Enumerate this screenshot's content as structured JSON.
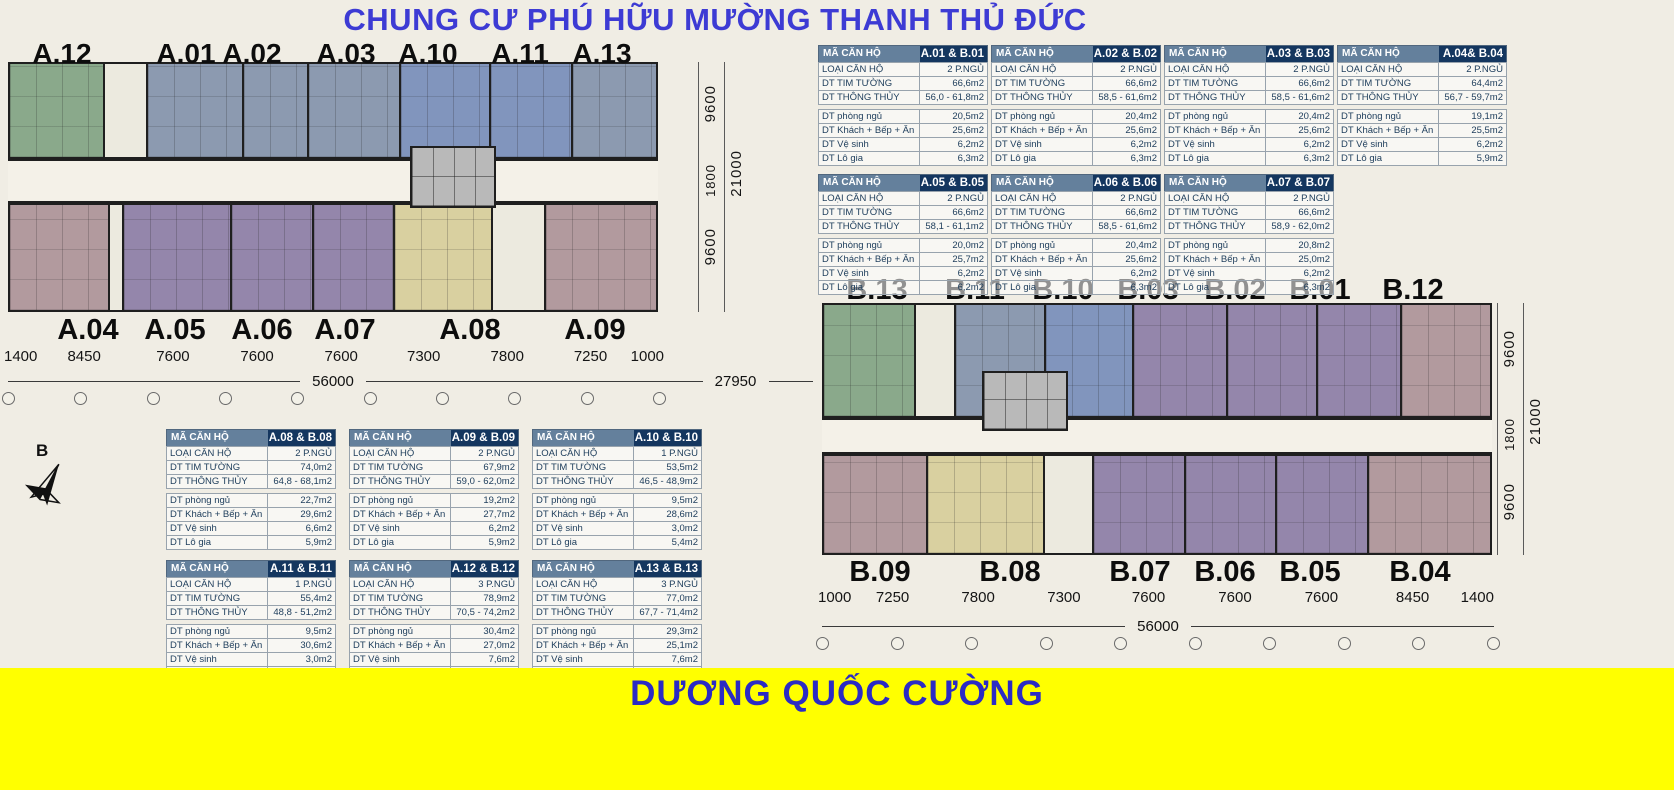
{
  "title": "CHUNG CƯ PHÚ HỮU MƯỜNG THANH THỦ ĐỨC",
  "footer": "DƯƠNG QUỐC CƯỜNG",
  "compass": {
    "north_label": "B"
  },
  "colors": {
    "title_blue": "#3d3bd4",
    "footer_yellow": "#ffff00",
    "footer_text_blue": "#2b2bc4",
    "table_header_steel": "#64809c",
    "table_header_navy": "#14365f",
    "unit_green": "#8aa98b",
    "unit_slate": "#8c9ab0",
    "unit_blue": "#8195bd",
    "unit_purple": "#9486ab",
    "unit_mauve": "#b29a9e",
    "unit_tan": "#d9d0a0"
  },
  "block_a": {
    "top_labels": [
      "A.12",
      "A.01",
      "A.02",
      "A.03",
      "A.10",
      "A.11",
      "A.13"
    ],
    "bottom_labels": [
      "A.04",
      "A.05",
      "A.06",
      "A.07",
      "A.08",
      "A.09"
    ],
    "dims_bottom": [
      "1400",
      "8450",
      "7600",
      "7600",
      "7600",
      "7300",
      "7800",
      "7250",
      "1000"
    ],
    "dim_total": "56000",
    "dim_gap": "27950",
    "dims_side": [
      "9600",
      "1800",
      "9600"
    ],
    "dim_side_total": "21000"
  },
  "block_b": {
    "top_labels": [
      "B.13",
      "B.11",
      "B.10",
      "B.03",
      "B.02",
      "B.01",
      "B.12"
    ],
    "bottom_labels": [
      "B.09",
      "B.08",
      "B.07",
      "B.06",
      "B.05",
      "B.04"
    ],
    "dims_bottom": [
      "1000",
      "7250",
      "7800",
      "7300",
      "7600",
      "7600",
      "7600",
      "8450",
      "1400"
    ],
    "dim_total": "56000",
    "dims_side": [
      "9600",
      "1800",
      "9600"
    ],
    "dim_side_total": "21000"
  },
  "table_labels": {
    "code": "MÃ CĂN HỘ",
    "type": "LOẠI CĂN HỘ",
    "tim": "DT TIM TƯỜNG",
    "thong": "DT THÔNG THỦY",
    "ngu": "DT phòng ngủ",
    "khach": "DT Khách + Bếp + Ăn",
    "ve": "DT Vệ sinh",
    "lo": "DT Lô gia"
  },
  "tables": [
    {
      "code": "A.01 & B.01",
      "type": "2 P.NGỦ",
      "tim": "66,6m2",
      "thong": "56,0 - 61,8m2",
      "ngu": "20,5m2",
      "khach": "25,6m2",
      "ve": "6,2m2",
      "lo": "6,3m2"
    },
    {
      "code": "A.02 & B.02",
      "type": "2 P.NGỦ",
      "tim": "66,6m2",
      "thong": "58,5 - 61,6m2",
      "ngu": "20,4m2",
      "khach": "25,6m2",
      "ve": "6,2m2",
      "lo": "6,3m2"
    },
    {
      "code": "A.03 & B.03",
      "type": "2 P.NGỦ",
      "tim": "66,6m2",
      "thong": "58,5 - 61,6m2",
      "ngu": "20,4m2",
      "khach": "25,6m2",
      "ve": "6,2m2",
      "lo": "6,3m2"
    },
    {
      "code": "A.04& B.04",
      "type": "2 P.NGỦ",
      "tim": "64,4m2",
      "thong": "56,7 - 59,7m2",
      "ngu": "19,1m2",
      "khach": "25,5m2",
      "ve": "6,2m2",
      "lo": "5,9m2"
    },
    {
      "code": "A.05 & B.05",
      "type": "2 P.NGỦ",
      "tim": "66,6m2",
      "thong": "58,1 - 61,1m2",
      "ngu": "20,0m2",
      "khach": "25,7m2",
      "ve": "6,2m2",
      "lo": "6,2m2"
    },
    {
      "code": "A.06 & B.06",
      "type": "2 P.NGỦ",
      "tim": "66,6m2",
      "thong": "58,5 - 61,6m2",
      "ngu": "20,4m2",
      "khach": "25,6m2",
      "ve": "6,2m2",
      "lo": "6,3m2"
    },
    {
      "code": "A.07 & B.07",
      "type": "2 P.NGỦ",
      "tim": "66,6m2",
      "thong": "58,9 - 62,0m2",
      "ngu": "20,8m2",
      "khach": "25,0m2",
      "ve": "6,2m2",
      "lo": "6,3m2"
    },
    {
      "code": "A.08 & B.08",
      "type": "2 P.NGỦ",
      "tim": "74,0m2",
      "thong": "64,8 - 68,1m2",
      "ngu": "22,7m2",
      "khach": "29,6m2",
      "ve": "6,6m2",
      "lo": "5,9m2"
    },
    {
      "code": "A.09 & B.09",
      "type": "2 P.NGỦ",
      "tim": "67,9m2",
      "thong": "59,0 - 62,0m2",
      "ngu": "19,2m2",
      "khach": "27,7m2",
      "ve": "6,2m2",
      "lo": "5,9m2"
    },
    {
      "code": "A.10 & B.10",
      "type": "1 P.NGỦ",
      "tim": "53,5m2",
      "thong": "46,5 - 48,9m2",
      "ngu": "9,5m2",
      "khach": "28,6m2",
      "ve": "3,0m2",
      "lo": "5,4m2"
    },
    {
      "code": "A.11 & B.11",
      "type": "1 P.NGỦ",
      "tim": "55,4m2",
      "thong": "48,8 - 51,2m2",
      "ngu": "9,5m2",
      "khach": "30,6m2",
      "ve": "3,0m2",
      "lo": "5,7m2"
    },
    {
      "code": "A.12 & B.12",
      "type": "3 P.NGỦ",
      "tim": "78,9m2",
      "thong": "70,5 - 74,2m2",
      "ngu": "30,4m2",
      "khach": "27,0m2",
      "ve": "7,6m2",
      "lo": "5,5m2"
    },
    {
      "code": "A.13 & B.13",
      "type": "3 P.NGỦ",
      "tim": "77,0m2",
      "thong": "67,7 - 71,4m2",
      "ngu": "29,3m2",
      "khach": "25,1m2",
      "ve": "7,6m2",
      "lo": "5,5m2"
    }
  ]
}
